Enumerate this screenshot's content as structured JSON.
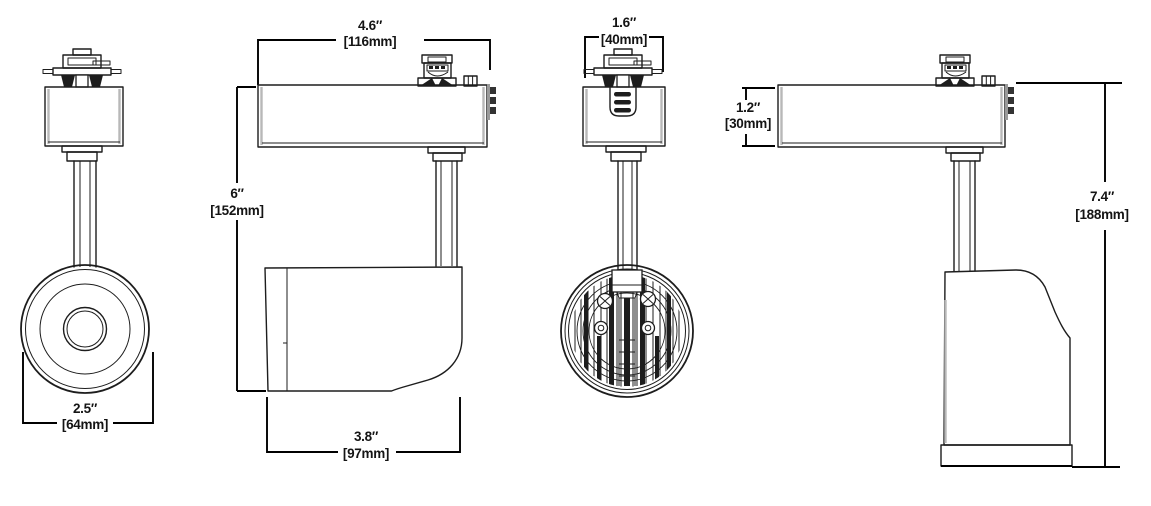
{
  "drawing": {
    "title": "Track light fixture dimensional drawing",
    "background": "#ffffff",
    "line_color": "#1d1d1d",
    "dimension_line_color": "#000000",
    "shade_color": "#b8b8b8",
    "views": [
      {
        "id": "front-view",
        "dimensions": [
          "lens_diameter"
        ]
      },
      {
        "id": "side-view-horizontal",
        "dimensions": [
          "head_width",
          "overall_height",
          "body_length"
        ]
      },
      {
        "id": "rear-view",
        "dimensions": [
          "adapter_width"
        ]
      },
      {
        "id": "side-view-aimed-down",
        "dimensions": [
          "housing_height",
          "overall_height_aimed_down"
        ]
      }
    ]
  },
  "dimensions": {
    "lens_diameter": {
      "in": "2.5″",
      "mm": "[64mm]"
    },
    "head_width": {
      "in": "4.6″",
      "mm": "[116mm]"
    },
    "overall_height": {
      "in": "6″",
      "mm": "[152mm]"
    },
    "body_length": {
      "in": "3.8″",
      "mm": "[97mm]"
    },
    "adapter_width": {
      "in": "1.6″",
      "mm": "[40mm]"
    },
    "housing_height": {
      "in": "1.2″",
      "mm": "[30mm]"
    },
    "overall_height_aimed_down": {
      "in": "7.4″",
      "mm": "[188mm]"
    }
  }
}
